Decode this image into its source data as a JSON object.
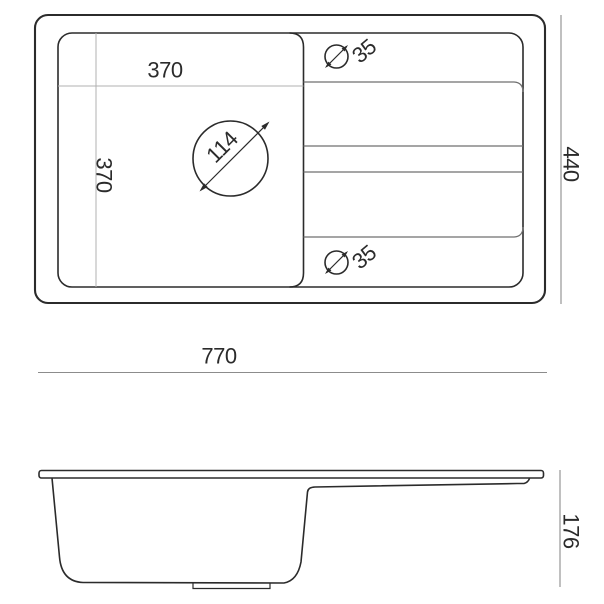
{
  "drawing": {
    "type": "technical-dimension-drawing",
    "subject": "kitchen sink with bowl and drainer board",
    "top_view": {
      "overall_width_mm": "770",
      "overall_depth_mm": "440",
      "bowl_width_mm": "370",
      "bowl_depth_mm": "370",
      "drain_hole_diameter_mm": "114",
      "tap_hole_top_diameter_mm": "35",
      "tap_hole_bottom_diameter_mm": "35"
    },
    "side_view": {
      "overall_height_mm": "176"
    },
    "colors": {
      "outline": "#2b2b2b",
      "dimension_line": "#8c8c8c",
      "light_dimension_line": "#b0b0b0",
      "drainer_line": "#6f6f6f",
      "text": "#2b2b2b",
      "background": "#ffffff"
    }
  }
}
